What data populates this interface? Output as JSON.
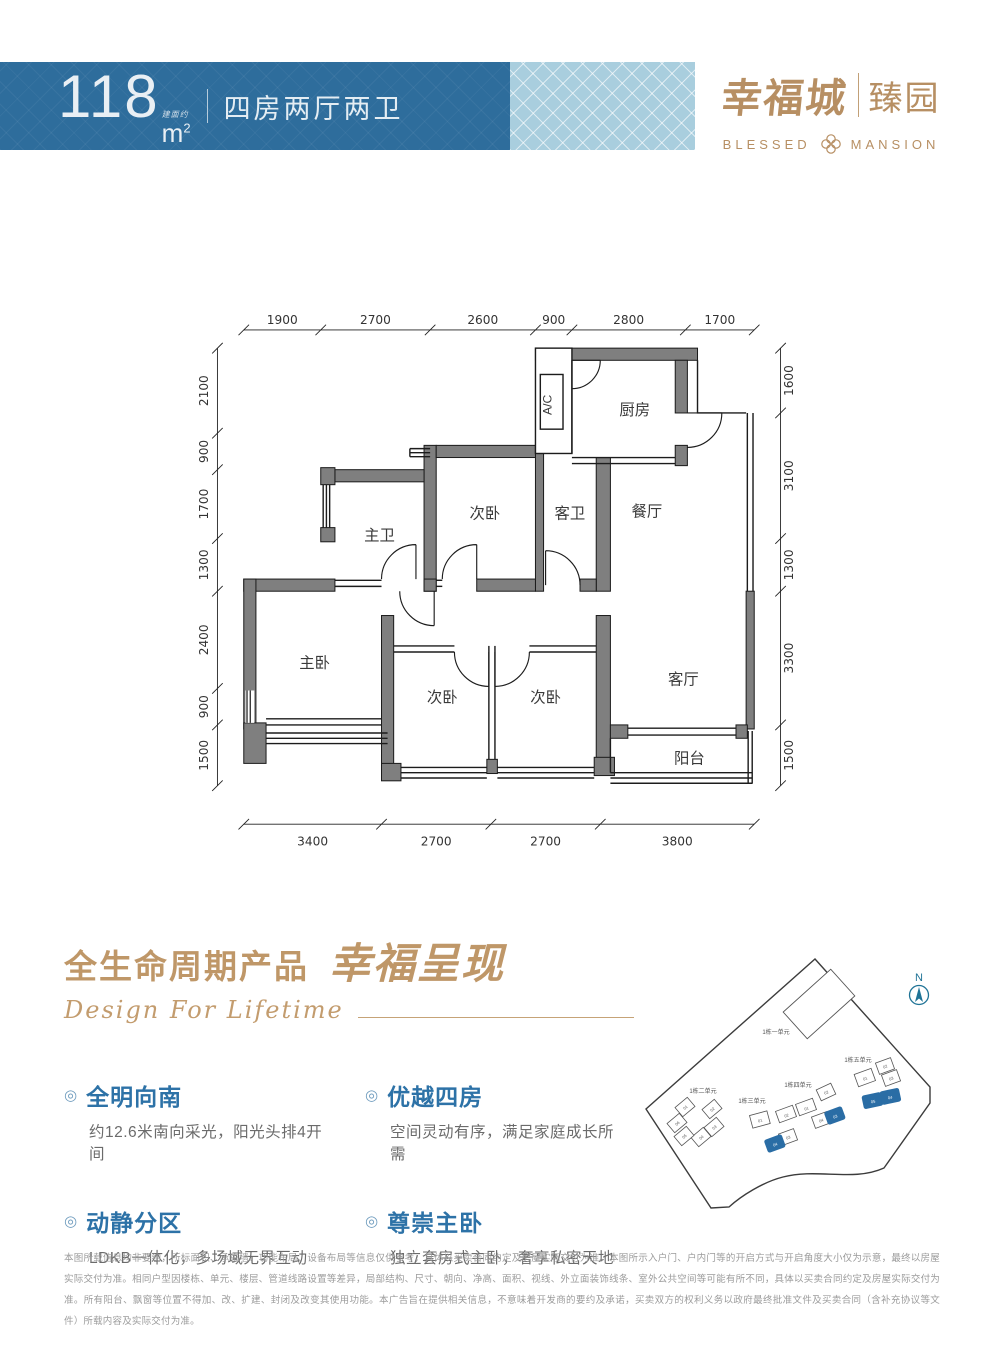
{
  "banner": {
    "area_value": "118",
    "area_note": "建面约",
    "area_m": "m",
    "area_sup": "2",
    "layout": "四房两厅两卫"
  },
  "logo": {
    "cn_main": "幸福城",
    "cn_sub": "臻园",
    "en_left": "BLESSED",
    "en_right": "MANSION"
  },
  "colors": {
    "banner_blue": "#2e6d9c",
    "banner_light_blue": "#a9cede",
    "gold": "#b78f63",
    "feature_blue": "#2d72a7",
    "wall_gray": "#7f7f7f",
    "highlight_unit_blue": "#2a6da5"
  },
  "floorplan": {
    "rooms": {
      "kitchen": "厨房",
      "dining": "餐厅",
      "living": "客厅",
      "balcony": "阳台",
      "master_bedroom": "主卧",
      "master_bath": "主卫",
      "guest_bath": "客卫",
      "bedroom_top": "次卧",
      "bedroom_left": "次卧",
      "bedroom_right": "次卧",
      "ac": "A/C"
    },
    "dims_top": [
      "1900",
      "2700",
      "2600",
      "900",
      "2800",
      "1700"
    ],
    "dims_bottom": [
      "3400",
      "2700",
      "2700",
      "3800"
    ],
    "dims_left": [
      "2100",
      "900",
      "1700",
      "1300",
      "2400",
      "900",
      "1500"
    ],
    "dims_right": [
      "1600",
      "3100",
      "1300",
      "3300",
      "1500"
    ]
  },
  "section_title": {
    "cn": "全生命周期产品",
    "cn_script": "幸福呈现",
    "en": "Design For Lifetime"
  },
  "features": [
    {
      "title": "全明向南",
      "desc": "约12.6米南向采光，阳光头排4开间"
    },
    {
      "title": "优越四房",
      "desc": "空间灵动有序，满足家庭成长所需"
    },
    {
      "title": "动静分区",
      "desc": "LDKB一体化，多场域无界互动"
    },
    {
      "title": "尊崇主卧",
      "desc": "独立套房式主卧，奢享私密天地"
    }
  ],
  "sitemap": {
    "north_label": "N",
    "buildings": [
      {
        "name": "1栋一单元",
        "units": []
      },
      {
        "name": "1栋二单元",
        "units": [
          {
            "label": "01"
          },
          {
            "label": "02"
          },
          {
            "label": "03"
          },
          {
            "label": "04"
          },
          {
            "label": "05"
          },
          {
            "label": "06"
          }
        ]
      },
      {
        "name": "1栋三单元",
        "units": [
          {
            "label": "01"
          },
          {
            "label": "02"
          },
          {
            "label": "03"
          },
          {
            "label": "04",
            "highlight": true
          }
        ]
      },
      {
        "name": "1栋四单元",
        "units": [
          {
            "label": "01"
          },
          {
            "label": "02"
          },
          {
            "label": "03",
            "highlight": true
          },
          {
            "label": "04"
          }
        ]
      },
      {
        "name": "1栋五单元",
        "units": [
          {
            "label": "01"
          },
          {
            "label": "02"
          },
          {
            "label": "03"
          },
          {
            "label": "04",
            "highlight": true
          },
          {
            "label": "05",
            "highlight": true
          }
        ]
      }
    ]
  },
  "disclaimer": [
    "本图所载信息均非要约，所标面积、承重墙、功能布局、设备布局等信息仅供参考，具体以买卖合同约定及房屋实际交付为准。本图所示入户门、户内门等的开启方式与开启角度大小仅为示意，最终以房屋实际交付为准。相同户型因楼",
    "栋、单元、楼层、管道线路设置等差异，局部结构、尺寸、朝向、净高、面积、视线、外立面装饰线条、室外公共空间等可能有所不同，具体以买卖合同约定及房屋实际交付为准。所有阳台、飘窗等位置不得加、改、扩建、封闭及改变",
    "其使用功能。本广告旨在提供相关信息，不意味着开发商的要约及承诺，买卖双方的权利义务以政府最终批准文件及买卖合同（含补充协议等文件）所载内容及实际交付为准。"
  ]
}
